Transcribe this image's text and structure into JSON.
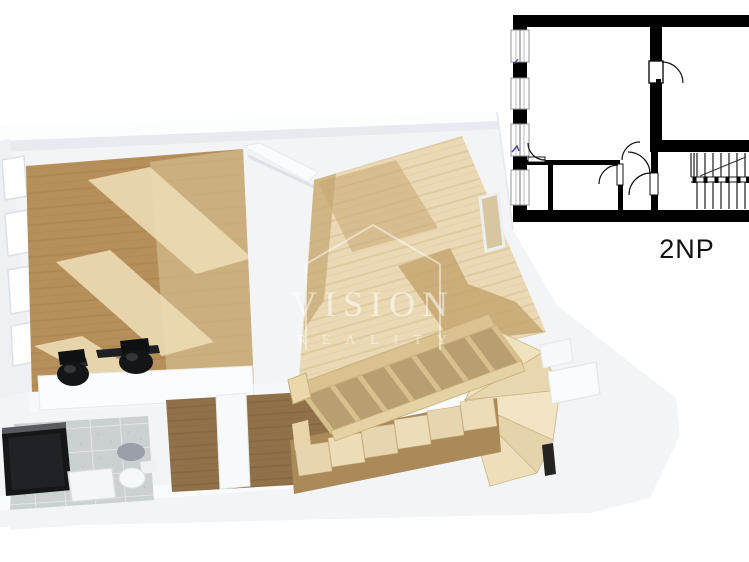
{
  "watermark": {
    "title": "VISION",
    "subtitle": "R E A L I T Y"
  },
  "plan2d": {
    "floor_label": "2NP"
  },
  "colors": {
    "background": "#ffffff",
    "slab_white": "#f3f4f6",
    "wall_highlight": "#fcfdfd",
    "wall_shadow": "#e7eaee",
    "wood_dark": "#b78f5a",
    "wood_stripe_dark": "#a5814e",
    "wood_sunlit": "#ecdcb4",
    "wood_pale": "#ead9b4",
    "wood_stripe_pale": "#dcc79c",
    "wood_hall": "#91714a",
    "wood_hall_stripe": "#7d603c",
    "stair_light": "#f0e1bf",
    "stair_mid": "#d9c28f",
    "stair_dark": "#a98a58",
    "tile_gray": "#cbd0d3",
    "tile_grout": "#e9ebed",
    "furniture_black": "#141619",
    "plan_black": "#000000",
    "label_text": "#111111",
    "watermark_white": "rgba(255,255,255,0.55)",
    "annotation_blue": "#4a3f8f"
  }
}
